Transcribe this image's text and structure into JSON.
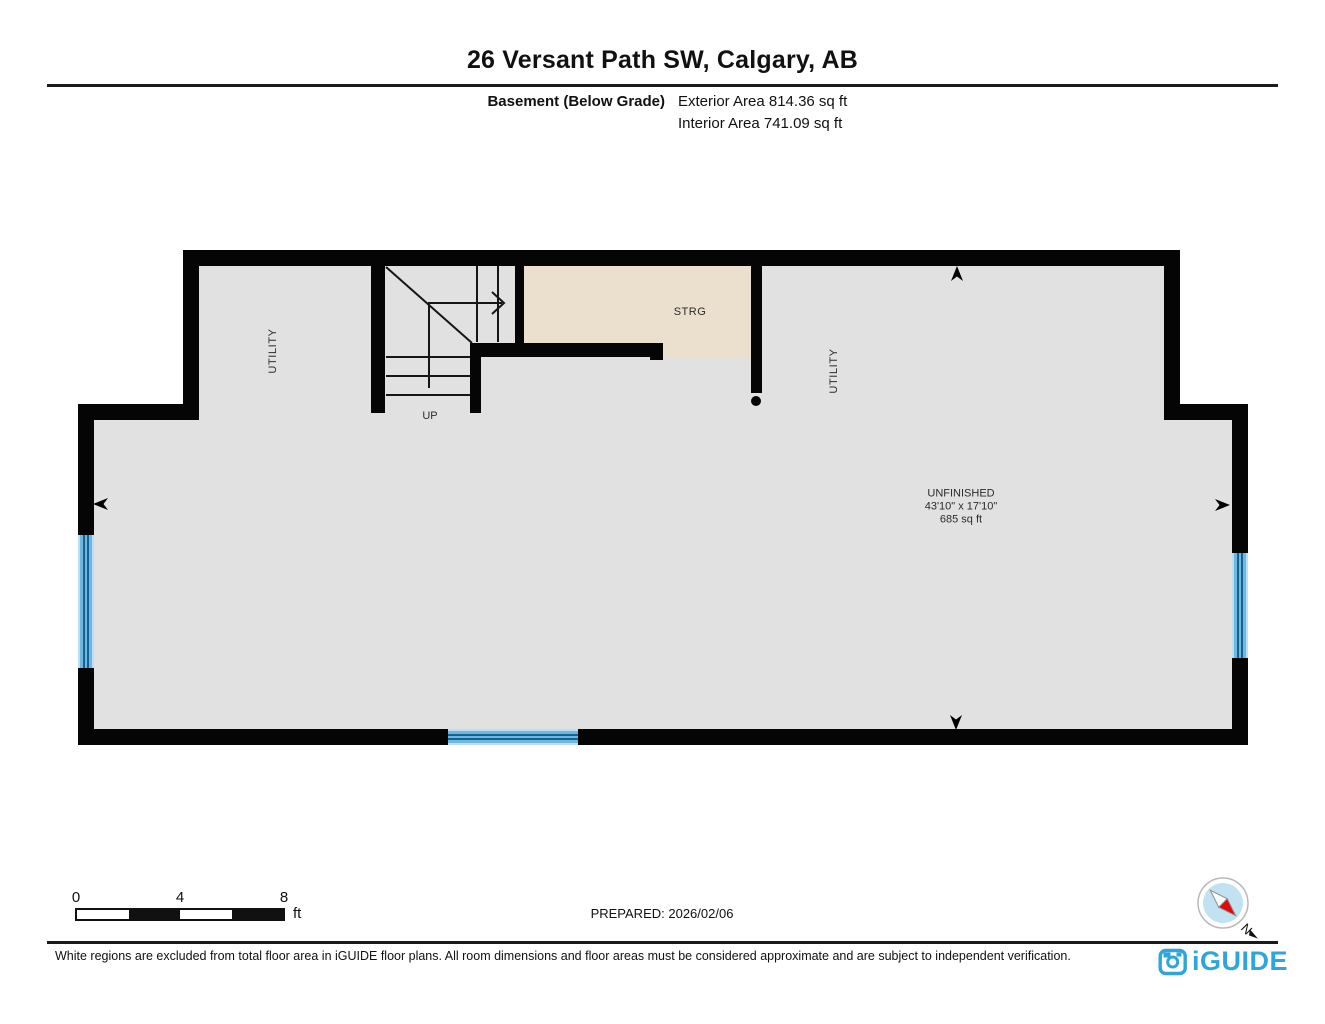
{
  "header": {
    "title": "26 Versant Path SW, Calgary, AB",
    "floor_label": "Basement (Below Grade)",
    "exterior_area": "Exterior Area 814.36 sq ft",
    "interior_area": "Interior Area 741.09 sq ft"
  },
  "plan": {
    "rooms": {
      "utility_left_label": "UTILITY",
      "utility_right_label": "UTILITY",
      "storage_label": "STRG",
      "stairs_up_label": "UP",
      "unfinished": {
        "name": "UNFINISHED",
        "dimensions": "43'10\" x 17'10\"",
        "area": "685 sq ft"
      }
    },
    "icons": {
      "entry_markers": "dart-arrowheads (up, down, left, right)",
      "stairs_direction": "right-arrow",
      "column": "black-dot"
    },
    "colors": {
      "wall": "#050505",
      "floor_gray": "#e1e1e1",
      "storage_tan": "#ebdfcd",
      "window_blue": "#6fb7e3",
      "window_line": "#17618f"
    }
  },
  "footer": {
    "scale_bar": {
      "tick_labels": [
        "0",
        "4",
        "8"
      ],
      "unit": "ft"
    },
    "prepared": "PREPARED: 2026/02/06",
    "compass_north_label": "N",
    "disclaimer": "White regions are excluded from total floor area in iGUIDE floor plans. All room dimensions and floor areas must be considered approximate and are subject to independent verification.",
    "brand": "iGUIDE",
    "brand_color": "#2fa6db"
  }
}
